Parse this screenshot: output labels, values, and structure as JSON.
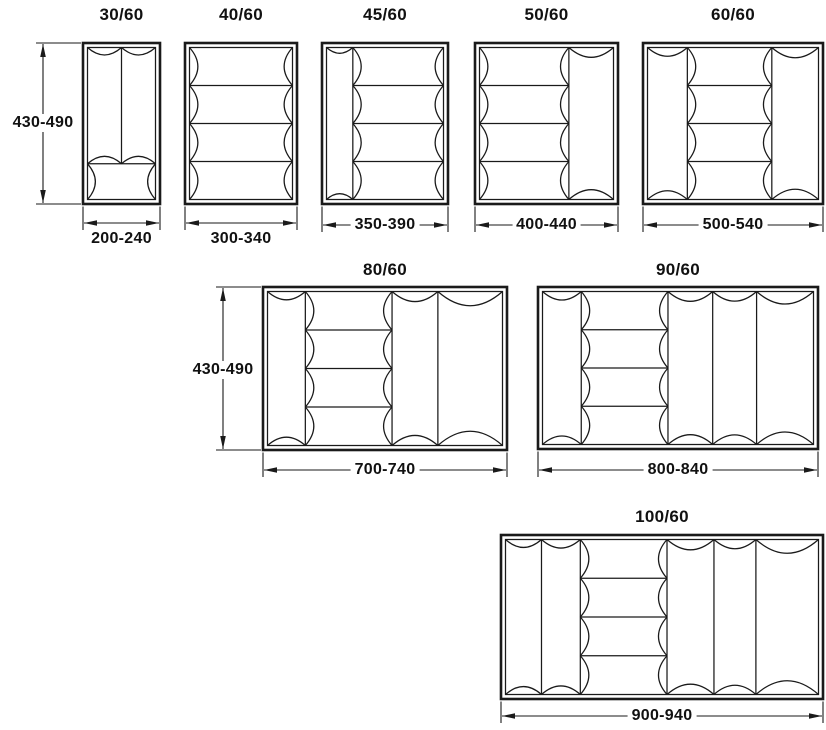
{
  "colors": {
    "line": "#1a1a1a",
    "text": "#111111",
    "background": "#ffffff"
  },
  "diagram": {
    "description": "Cutlery tray insert size chart, top views with dimension ranges in mm",
    "trays": [
      {
        "label": "30/60",
        "width_label": "200-240",
        "width_label_style": "below",
        "height_label": "430-490",
        "layout": {
          "x": 83,
          "y": 43,
          "w": 77,
          "h": 161,
          "title_cy": 15,
          "dim_y": 223
        },
        "sections_direction": "vertical",
        "sections": [
          {
            "kind": "columns",
            "count": 2,
            "size": 0.765
          },
          {
            "kind": "row",
            "size": 0.235
          }
        ]
      },
      {
        "label": "40/60",
        "width_label": "300-340",
        "width_label_style": "below",
        "layout": {
          "x": 185,
          "y": 43,
          "w": 112,
          "h": 161,
          "title_cy": 15,
          "dim_y": 223
        },
        "sections_direction": "horizontal",
        "sections": [
          {
            "kind": "rows",
            "count": 4,
            "size": 1.0
          }
        ]
      },
      {
        "label": "45/60",
        "width_label": "350-390",
        "width_label_style": "inline",
        "layout": {
          "x": 322,
          "y": 43,
          "w": 126,
          "h": 161,
          "title_cy": 15,
          "dim_y": 225
        },
        "sections_direction": "horizontal",
        "sections": [
          {
            "kind": "column",
            "size": 0.225
          },
          {
            "kind": "rows",
            "count": 4,
            "size": 0.775
          }
        ]
      },
      {
        "label": "50/60",
        "width_label": "400-440",
        "width_label_style": "inline",
        "layout": {
          "x": 475,
          "y": 43,
          "w": 143,
          "h": 161,
          "title_cy": 15,
          "dim_y": 225
        },
        "sections_direction": "horizontal",
        "sections": [
          {
            "kind": "rows",
            "count": 4,
            "size": 0.667
          },
          {
            "kind": "column",
            "size": 0.333
          }
        ]
      },
      {
        "label": "60/60",
        "width_label": "500-540",
        "width_label_style": "inline",
        "layout": {
          "x": 643,
          "y": 43,
          "w": 180,
          "h": 161,
          "title_cy": 15,
          "dim_y": 225
        },
        "sections_direction": "horizontal",
        "sections": [
          {
            "kind": "column",
            "size": 0.233
          },
          {
            "kind": "rows",
            "count": 4,
            "size": 0.494
          },
          {
            "kind": "column",
            "size": 0.273
          }
        ]
      },
      {
        "label": "80/60",
        "width_label": "700-740",
        "width_label_style": "inline",
        "height_label": "430-490",
        "layout": {
          "x": 263,
          "y": 287,
          "w": 244,
          "h": 163,
          "title_cy": 270,
          "dim_y": 470
        },
        "sections_direction": "horizontal",
        "sections": [
          {
            "kind": "column",
            "size": 0.161
          },
          {
            "kind": "rows",
            "count": 4,
            "size": 0.369
          },
          {
            "kind": "column",
            "size": 0.195
          },
          {
            "kind": "column",
            "size": 0.275
          }
        ]
      },
      {
        "label": "90/60",
        "width_label": "800-840",
        "width_label_style": "inline",
        "layout": {
          "x": 538,
          "y": 287,
          "w": 280,
          "h": 162,
          "title_cy": 270,
          "dim_y": 470
        },
        "sections_direction": "horizontal",
        "sections": [
          {
            "kind": "column",
            "size": 0.143
          },
          {
            "kind": "rows",
            "count": 4,
            "size": 0.32
          },
          {
            "kind": "column",
            "size": 0.165
          },
          {
            "kind": "column",
            "size": 0.162
          },
          {
            "kind": "column",
            "size": 0.21
          }
        ]
      },
      {
        "label": "100/60",
        "width_label": "900-940",
        "width_label_style": "inline",
        "layout": {
          "x": 501,
          "y": 535,
          "w": 322,
          "h": 164,
          "title_cy": 517,
          "dim_y": 716
        },
        "sections_direction": "horizontal",
        "sections": [
          {
            "kind": "column",
            "size": 0.115
          },
          {
            "kind": "column",
            "size": 0.124
          },
          {
            "kind": "rows",
            "count": 4,
            "size": 0.277
          },
          {
            "kind": "column",
            "size": 0.15
          },
          {
            "kind": "column",
            "size": 0.134
          },
          {
            "kind": "column",
            "size": 0.2
          }
        ]
      }
    ],
    "height_dims": [
      {
        "label": "430-490",
        "line_x": 43,
        "y1": 43,
        "y2": 204,
        "ext_to_x": 81,
        "text_cy": 123
      },
      {
        "label": "430-490",
        "line_x": 223,
        "y1": 287,
        "y2": 450,
        "ext_to_x": 261,
        "text_cy": 370
      }
    ]
  }
}
